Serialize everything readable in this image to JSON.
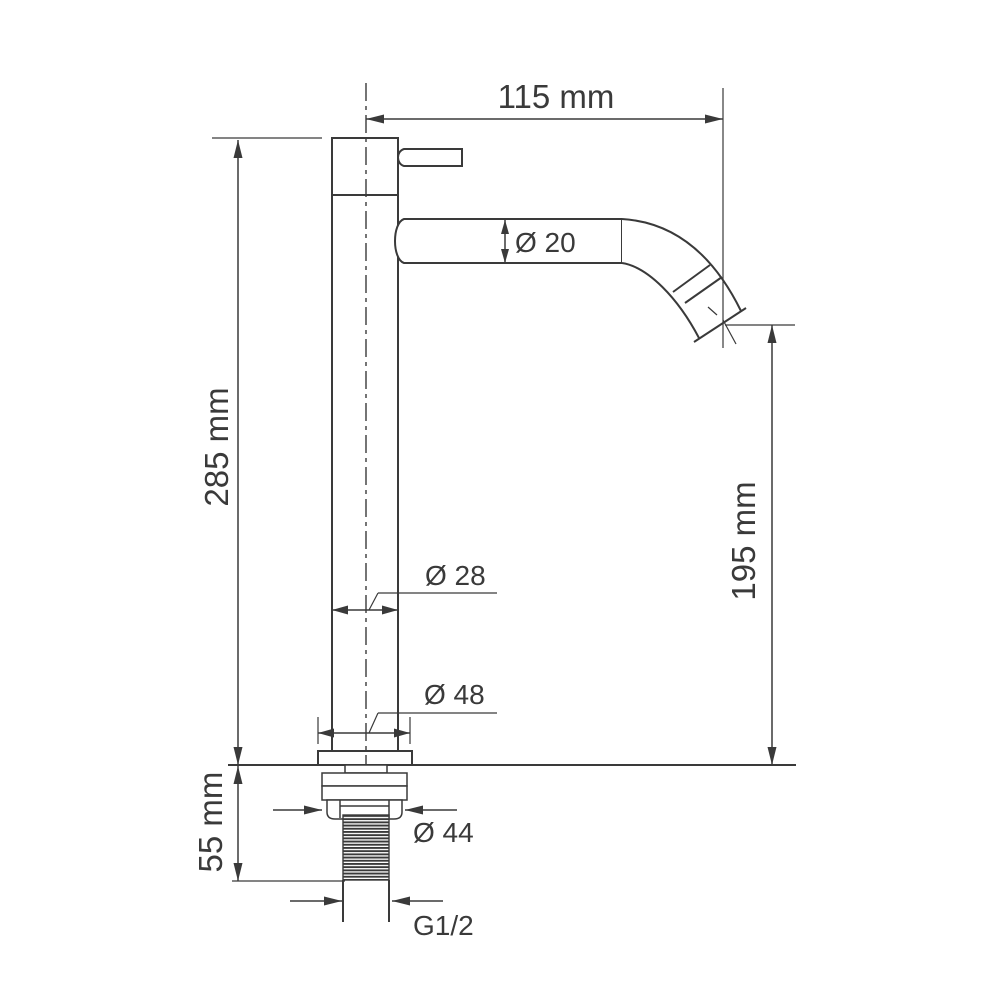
{
  "drawing": {
    "type": "technical-dimension-drawing",
    "subject": "tall single-lever basin faucet, side elevation with installation dimensions",
    "units": "mm",
    "colors": {
      "line": "#3a3a3a",
      "text": "#3a3a3a",
      "background": "#ffffff"
    },
    "dimensions": {
      "spout_reach": "115 mm",
      "total_height": "285 mm",
      "spout_outlet_height": "195 mm",
      "spout_tube_diameter": "Ø 20",
      "body_diameter": "Ø 28",
      "base_diameter": "Ø 48",
      "locknut_diameter": "Ø 44",
      "inlet_thread": "G1/2",
      "under_counter_depth": "55 mm"
    }
  }
}
